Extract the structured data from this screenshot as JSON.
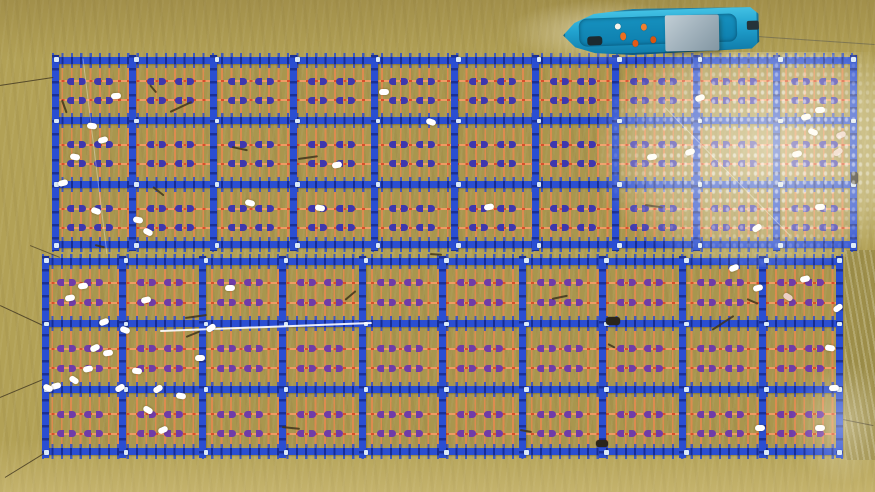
{
  "scene": {
    "width": 875,
    "height": 492,
    "description": "Aerial top-down view of two large floating aquaculture rafts (blue plastic frames with orange rope lattice and purple clip floats) on turbid olive-brown river water; a blue workboat with grey canopy and crew in orange life vests is moored at the top edge; white buoys and mooring lines are scattered across the rafts; sun glare brightens the upper-right water."
  },
  "palette": {
    "water": "#b2a156",
    "water_top": "#a8974d",
    "water_bottom": "#c3b065",
    "beam_blue": "#2a4ed2",
    "beam_dark": "#17289b",
    "rope_orange": "#e08a4f",
    "rope_red": "#d6502c",
    "clip_upper": "#3e37ae",
    "clip_lower": "#6f3ca8",
    "buoy_white": "#ffffff",
    "buoy_pink": "#eccfc4",
    "boat_hull": "#22a6d2",
    "boat_canopy": "#9fb0ba",
    "vest_orange": "#ee6f1f",
    "glare": "#fffbe8"
  },
  "rafts": [
    {
      "id": "raft-upper",
      "x": 52,
      "y": 57,
      "w": 805,
      "h": 191,
      "cols": 10,
      "rows": 3,
      "clip_row_fracs": [
        0.38,
        0.68
      ],
      "clip_x_fracs": [
        0.3,
        0.64
      ],
      "clip_color": "#3e37ae"
    },
    {
      "id": "raft-lower",
      "x": 42,
      "y": 258,
      "w": 801,
      "h": 197,
      "cols": 10,
      "rows": 3,
      "clip_row_fracs": [
        0.38,
        0.68
      ],
      "clip_x_fracs": [
        0.3,
        0.64
      ],
      "clip_color": "#6f3ca8"
    }
  ],
  "glare": {
    "main": {
      "x": 598,
      "y": 52,
      "w": 277,
      "h": 215
    },
    "corner": {
      "x": 790,
      "y": 360,
      "w": 85,
      "h": 125
    }
  },
  "boat": {
    "x": 563,
    "y": 8,
    "w": 196,
    "h": 46,
    "rot": -2,
    "deck": {
      "x": 16,
      "y": 8,
      "w": 158,
      "h": 28
    },
    "canopy": {
      "x": 102,
      "y": 8,
      "w": 54,
      "h": 36,
      "rot": 1
    },
    "motor": {
      "x": 184,
      "y": 16,
      "w": 12,
      "h": 9
    },
    "bow_gear": {
      "x": 24,
      "y": 26,
      "w": 15,
      "h": 9
    },
    "crew": [
      {
        "x": 52,
        "y": 14,
        "w": 6,
        "h": 6,
        "c": "#f5f3ea"
      },
      {
        "x": 57,
        "y": 23,
        "w": 6,
        "h": 8,
        "c": "#ee6f1f"
      },
      {
        "x": 69,
        "y": 31,
        "w": 6,
        "h": 7,
        "c": "#e35a14"
      },
      {
        "x": 78,
        "y": 15,
        "w": 6,
        "h": 7,
        "c": "#f08030"
      },
      {
        "x": 87,
        "y": 28,
        "w": 6,
        "h": 7,
        "c": "#d85510"
      }
    ],
    "wake": {
      "x": 505,
      "y": 0,
      "w": 190,
      "h": 64
    }
  },
  "buoys": [
    {
      "x": 116,
      "y": 96
    },
    {
      "x": 92,
      "y": 126
    },
    {
      "x": 103,
      "y": 140
    },
    {
      "x": 75,
      "y": 157
    },
    {
      "x": 63,
      "y": 183
    },
    {
      "x": 96,
      "y": 211
    },
    {
      "x": 138,
      "y": 220
    },
    {
      "x": 148,
      "y": 232
    },
    {
      "x": 250,
      "y": 203
    },
    {
      "x": 320,
      "y": 208
    },
    {
      "x": 337,
      "y": 165
    },
    {
      "x": 384,
      "y": 92
    },
    {
      "x": 431,
      "y": 122
    },
    {
      "x": 489,
      "y": 207
    },
    {
      "x": 652,
      "y": 157
    },
    {
      "x": 690,
      "y": 152
    },
    {
      "x": 700,
      "y": 98
    },
    {
      "x": 757,
      "y": 228
    },
    {
      "x": 820,
      "y": 110
    },
    {
      "x": 806,
      "y": 117
    },
    {
      "x": 813,
      "y": 132
    },
    {
      "x": 797,
      "y": 154
    },
    {
      "x": 820,
      "y": 207
    },
    {
      "x": 841,
      "y": 135,
      "c": "#eccfc4"
    },
    {
      "x": 838,
      "y": 152,
      "c": "#eccfc4"
    },
    {
      "x": 83,
      "y": 286
    },
    {
      "x": 70,
      "y": 298
    },
    {
      "x": 146,
      "y": 300
    },
    {
      "x": 125,
      "y": 330
    },
    {
      "x": 104,
      "y": 322
    },
    {
      "x": 95,
      "y": 348
    },
    {
      "x": 108,
      "y": 353
    },
    {
      "x": 88,
      "y": 369
    },
    {
      "x": 74,
      "y": 380
    },
    {
      "x": 56,
      "y": 386
    },
    {
      "x": 120,
      "y": 388
    },
    {
      "x": 137,
      "y": 371
    },
    {
      "x": 148,
      "y": 410
    },
    {
      "x": 163,
      "y": 430
    },
    {
      "x": 181,
      "y": 396
    },
    {
      "x": 200,
      "y": 358
    },
    {
      "x": 211,
      "y": 328
    },
    {
      "x": 230,
      "y": 288
    },
    {
      "x": 158,
      "y": 389
    },
    {
      "x": 48,
      "y": 388
    },
    {
      "x": 734,
      "y": 268
    },
    {
      "x": 758,
      "y": 288
    },
    {
      "x": 788,
      "y": 297,
      "c": "#eccfc4"
    },
    {
      "x": 805,
      "y": 279
    },
    {
      "x": 838,
      "y": 308
    },
    {
      "x": 830,
      "y": 348
    },
    {
      "x": 834,
      "y": 388
    },
    {
      "x": 820,
      "y": 428
    },
    {
      "x": 760,
      "y": 428
    }
  ],
  "dark_floats": [
    {
      "x": 606,
      "y": 317,
      "w": 14,
      "h": 8
    },
    {
      "x": 851,
      "y": 172,
      "w": 7,
      "h": 12
    },
    {
      "x": 596,
      "y": 440,
      "w": 12,
      "h": 7
    }
  ],
  "debris": [
    {
      "x": 170,
      "y": 112,
      "len": 24,
      "rot": -25
    },
    {
      "x": 232,
      "y": 147,
      "len": 16,
      "rot": 12
    },
    {
      "x": 298,
      "y": 159,
      "len": 20,
      "rot": -8
    },
    {
      "x": 153,
      "y": 187,
      "len": 14,
      "rot": 38
    },
    {
      "x": 645,
      "y": 205,
      "len": 18,
      "rot": 8
    },
    {
      "x": 712,
      "y": 330,
      "len": 26,
      "rot": -33
    },
    {
      "x": 747,
      "y": 299,
      "len": 12,
      "rot": 24
    },
    {
      "x": 282,
      "y": 427,
      "len": 18,
      "rot": 6
    },
    {
      "x": 186,
      "y": 337,
      "len": 15,
      "rot": -22
    },
    {
      "x": 95,
      "y": 245,
      "len": 10,
      "rot": 14
    },
    {
      "x": 552,
      "y": 299,
      "len": 16,
      "rot": -12
    },
    {
      "x": 608,
      "y": 344,
      "len": 8,
      "rot": 28
    },
    {
      "x": 430,
      "y": 254,
      "len": 12,
      "rot": 4
    },
    {
      "x": 185,
      "y": 318,
      "len": 22,
      "rot": -8
    },
    {
      "x": 62,
      "y": 100,
      "len": 14,
      "rot": 70
    },
    {
      "x": 150,
      "y": 85,
      "len": 10,
      "rot": 50
    },
    {
      "x": 345,
      "y": 300,
      "len": 14,
      "rot": -40
    },
    {
      "x": 520,
      "y": 430,
      "len": 12,
      "rot": 10
    }
  ],
  "lines": [
    {
      "x1": 0,
      "y1": 86,
      "x2": 53,
      "y2": 78,
      "c": "rgba(70,60,35,0.85)",
      "t": 1.3
    },
    {
      "x1": 0,
      "y1": 306,
      "x2": 43,
      "y2": 326,
      "c": "rgba(70,60,35,0.85)",
      "t": 1.3
    },
    {
      "x1": 0,
      "y1": 398,
      "x2": 43,
      "y2": 380,
      "c": "rgba(70,60,35,0.85)",
      "t": 1.3
    },
    {
      "x1": 5,
      "y1": 478,
      "x2": 44,
      "y2": 454,
      "c": "rgba(70,60,35,0.85)",
      "t": 1.3
    },
    {
      "x1": 843,
      "y1": 420,
      "x2": 873,
      "y2": 426,
      "c": "rgba(70,60,35,0.7)",
      "t": 1.2
    },
    {
      "x1": 757,
      "y1": 36,
      "x2": 875,
      "y2": 44,
      "c": "rgba(90,90,80,0.55)",
      "t": 1
    },
    {
      "x1": 30,
      "y1": 246,
      "x2": 60,
      "y2": 258,
      "c": "rgba(70,60,35,0.7)",
      "t": 1.2
    },
    {
      "x1": 160,
      "y1": 331,
      "x2": 372,
      "y2": 323,
      "c": "rgba(255,255,255,0.9)",
      "t": 1.6
    },
    {
      "x1": 665,
      "y1": 108,
      "x2": 790,
      "y2": 236,
      "c": "rgba(255,255,250,0.4)",
      "t": 1.2
    },
    {
      "x1": 83,
      "y1": 58,
      "x2": 107,
      "y2": 254,
      "c": "rgba(255,255,250,0.35)",
      "t": 1
    }
  ]
}
